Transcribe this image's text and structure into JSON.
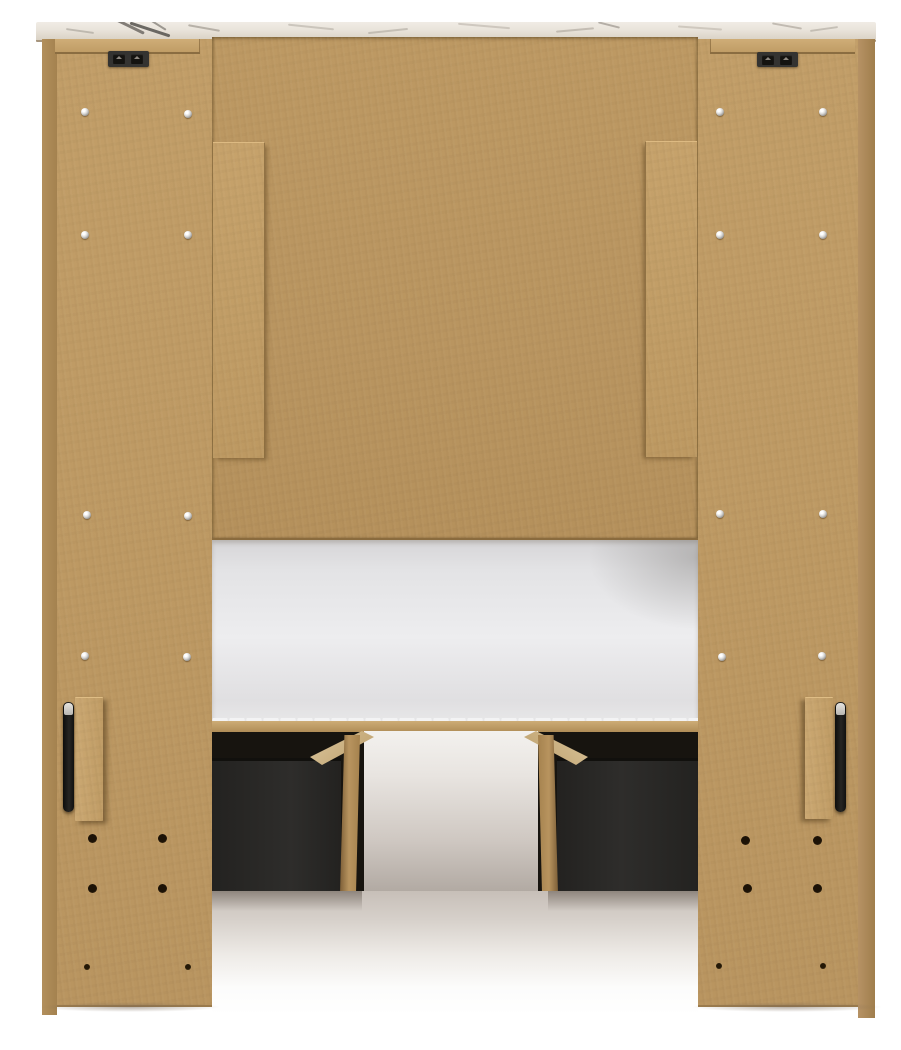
{
  "meta": {
    "description": "Product photograph: back view of a light-wood (MDF) bookcase headboard twin storage bed with two dark under-bed storage drawers, a white mattress on the platform, whitewashed wood-grain top cap, black mounting brackets and handles, assembly screws and pilot holes.",
    "visible_text": ""
  },
  "scene": {
    "background": "#ffffff",
    "colors": {
      "panel": "#bd9963",
      "panel_edge": "#a8865c",
      "back_panel": "#b99560",
      "batten": "#c19d67",
      "rail": "#c6a26c",
      "cap_base": "#e9e3da",
      "bracket": "#343331",
      "bracket_slot": "#141310",
      "screw": "#d9d8d6",
      "hole": "#3a2a14",
      "mattress": "#ededef",
      "platform": "#c2a069",
      "underbed_dark": "#17140f",
      "drawer": "#2c2b29",
      "wood_rail": "#b8945f",
      "wood_rail_top": "#d5c09a",
      "glow_top": "#f3f1ee",
      "glow_bottom": "#b2aaa3",
      "floor_shadow": "#c7bfb8",
      "floor": "#ffffff",
      "handle": "#1a1918",
      "handle_tip": "#d9d7d3"
    },
    "parts": [
      {
        "name": "headboard-top-cap",
        "finish": "whitewashed marble-grain wood"
      },
      {
        "name": "left-side-panel",
        "finish": "natural MDF tan"
      },
      {
        "name": "right-side-panel",
        "finish": "natural MDF tan"
      },
      {
        "name": "headboard-back-panel",
        "finish": "natural MDF tan"
      },
      {
        "name": "vertical-battens",
        "count": 2
      },
      {
        "name": "mounting-brackets",
        "count": 2,
        "color": "black"
      },
      {
        "name": "side-handles",
        "count": 2,
        "color": "black"
      },
      {
        "name": "mattress",
        "color": "white"
      },
      {
        "name": "storage-drawers",
        "count": 2,
        "color": "dark charcoal"
      },
      {
        "name": "platform-side-rails",
        "count": 2,
        "finish": "tan wood"
      }
    ],
    "cap": {
      "veins": [
        {
          "x": 74,
          "y": 2,
          "w": 36,
          "h": 3,
          "rot": 26,
          "color": "#6e6a64",
          "op": 0.85
        },
        {
          "x": 93,
          "y": 6,
          "w": 42,
          "h": 3,
          "rot": 18,
          "color": "#55524d",
          "op": 0.85
        },
        {
          "x": 106,
          "y": 0,
          "w": 26,
          "h": 2,
          "rot": 32,
          "color": "#7a766f",
          "op": 0.7
        },
        {
          "x": 30,
          "y": 8,
          "w": 28,
          "h": 2,
          "rot": 8,
          "color": "#a49e95",
          "op": 0.6
        },
        {
          "x": 152,
          "y": 5,
          "w": 32,
          "h": 2,
          "rot": 10,
          "color": "#948d83",
          "op": 0.6
        },
        {
          "x": 252,
          "y": 4,
          "w": 46,
          "h": 2,
          "rot": 6,
          "color": "#aaa49a",
          "op": 0.5
        },
        {
          "x": 332,
          "y": 8,
          "w": 40,
          "h": 2,
          "rot": -6,
          "color": "#a29c92",
          "op": 0.5
        },
        {
          "x": 422,
          "y": 3,
          "w": 52,
          "h": 2,
          "rot": 5,
          "color": "#b0a89d",
          "op": 0.5
        },
        {
          "x": 520,
          "y": 7,
          "w": 38,
          "h": 2,
          "rot": -5,
          "color": "#9d968c",
          "op": 0.5
        },
        {
          "x": 562,
          "y": 2,
          "w": 22,
          "h": 2,
          "rot": 14,
          "color": "#8d877e",
          "op": 0.6
        },
        {
          "x": 642,
          "y": 5,
          "w": 44,
          "h": 2,
          "rot": 4,
          "color": "#aca59a",
          "op": 0.45
        },
        {
          "x": 736,
          "y": 3,
          "w": 30,
          "h": 2,
          "rot": 10,
          "color": "#958e84",
          "op": 0.5
        },
        {
          "x": 774,
          "y": 6,
          "w": 28,
          "h": 2,
          "rot": -8,
          "color": "#a09a90",
          "op": 0.5
        }
      ]
    },
    "brackets": [
      {
        "x": 108,
        "y": 51,
        "w": 41,
        "h": 16
      },
      {
        "x": 757,
        "y": 52,
        "w": 41,
        "h": 15
      }
    ],
    "fasteners": {
      "screws": [
        [
          85,
          112
        ],
        [
          188,
          114
        ],
        [
          85,
          235
        ],
        [
          188,
          235
        ],
        [
          87,
          515
        ],
        [
          188,
          516
        ],
        [
          85,
          656
        ],
        [
          187,
          657
        ],
        [
          720,
          112
        ],
        [
          823,
          112
        ],
        [
          720,
          235
        ],
        [
          823,
          235
        ],
        [
          720,
          514
        ],
        [
          823,
          514
        ],
        [
          722,
          657
        ],
        [
          822,
          656
        ]
      ],
      "holes_large": [
        [
          92,
          838
        ],
        [
          162,
          838
        ],
        [
          92,
          888
        ],
        [
          162,
          888
        ],
        [
          745,
          840
        ],
        [
          817,
          840
        ],
        [
          747,
          888
        ],
        [
          817,
          888
        ]
      ],
      "holes_small": [
        [
          87,
          967
        ],
        [
          188,
          967
        ],
        [
          719,
          966
        ],
        [
          823,
          966
        ]
      ]
    }
  }
}
